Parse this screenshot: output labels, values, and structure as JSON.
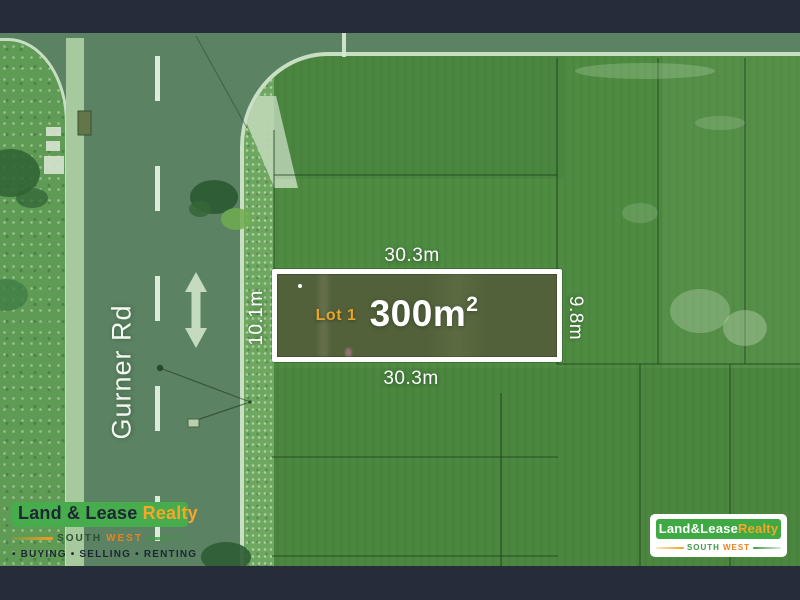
{
  "road": {
    "name": "Gurner Rd"
  },
  "lot": {
    "name": "Lot 1",
    "area_base": "300m",
    "area_sup": "2",
    "dim_top": "30.3m",
    "dim_bottom": "30.3m",
    "dim_left": "10.1m",
    "dim_right": "9.8m"
  },
  "logo_left": {
    "brand_primary": "Land & Lease ",
    "brand_accent": "Realty",
    "region_south": "SOUTH",
    "region_west": "WEST",
    "tagline": "• BUYING • SELLING • RENTING"
  },
  "logo_right": {
    "brand_primary": "Land&Lease",
    "brand_accent": "Realty",
    "region_south": "SOUTH",
    "region_west": "WEST"
  },
  "colors": {
    "letterbox_navy": "#262C3A",
    "brand_green": "#47AC4B",
    "brand_amber": "#F5A62B",
    "brand_orange": "#E8831F",
    "lot_outline_white": "#FFFFFF",
    "lot_label_amber": "#E6A42E",
    "road_green": "#5B8262",
    "paddock_green": "#4F8C42"
  }
}
